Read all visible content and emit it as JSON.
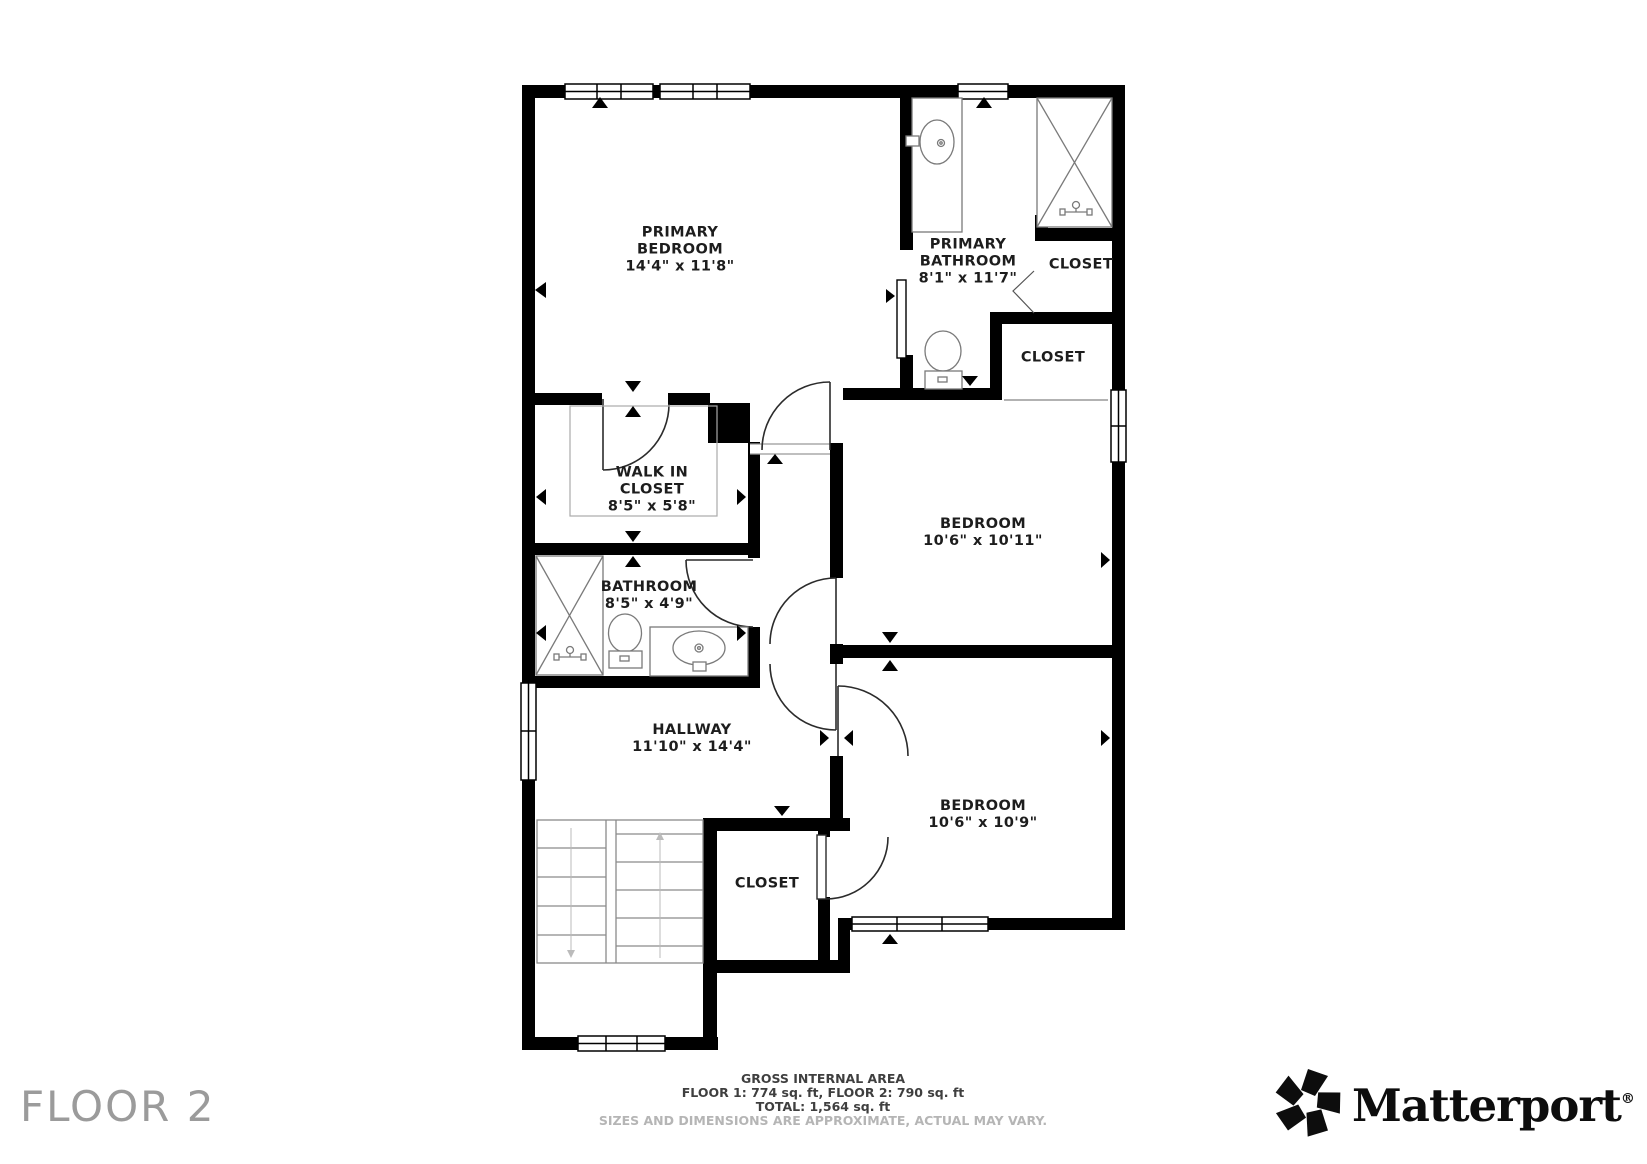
{
  "floor_label": "FLOOR 2",
  "brand": {
    "name": "Matterport",
    "reg": "®"
  },
  "footer": {
    "line1": "GROSS INTERNAL AREA",
    "line2": "FLOOR 1: 774 sq. ft, FLOOR 2: 790 sq. ft",
    "line3": "TOTAL: 1,564 sq. ft",
    "disclaimer": "SIZES AND DIMENSIONS ARE APPROXIMATE, ACTUAL MAY VARY."
  },
  "rooms": [
    {
      "id": "primary-bedroom",
      "label": "PRIMARY\nBEDROOM\n14'4\" x 11'8\""
    },
    {
      "id": "primary-bathroom",
      "label": "PRIMARY\nBATHROOM\n8'1\" x 11'7\""
    },
    {
      "id": "closet-top-right",
      "label": "CLOSET"
    },
    {
      "id": "closet-mid-right",
      "label": "CLOSET"
    },
    {
      "id": "walk-in-closet",
      "label": "WALK IN\nCLOSET\n8'5\" x 5'8\""
    },
    {
      "id": "bathroom",
      "label": "BATHROOM\n8'5\" x 4'9\""
    },
    {
      "id": "bedroom-1",
      "label": "BEDROOM\n10'6\" x 10'11\""
    },
    {
      "id": "hallway",
      "label": "HALLWAY\n11'10\" x 14'4\""
    },
    {
      "id": "bedroom-2",
      "label": "BEDROOM\n10'6\" x 10'9\""
    },
    {
      "id": "closet-bottom",
      "label": "CLOSET"
    }
  ],
  "colors": {
    "wall": "#000000",
    "label_text": "#1d1d1d",
    "muted_text": "#b5b5b5",
    "floor_label_text": "#9b9b9b",
    "background": "#ffffff"
  }
}
